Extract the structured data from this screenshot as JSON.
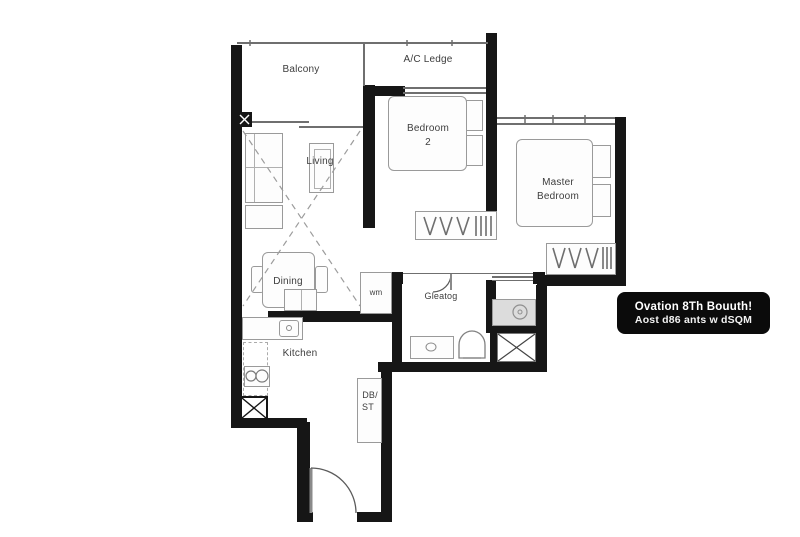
{
  "canvas": {
    "width": 800,
    "height": 537,
    "background": "#ffffff"
  },
  "colors": {
    "wall": "#161616",
    "thin_line": "#6f6f6f",
    "furniture_stroke": "#9a9a9a",
    "label_text": "#3d3d3d",
    "shower_fill": "#dcdcdc",
    "badge_background": "#0b0b0b",
    "badge_text": "#ffffff"
  },
  "rooms": {
    "balcony": "Balcony",
    "ac_ledge": "A/C Ledge",
    "living": "Living",
    "dining": "Dining",
    "kitchen": "Kitchen",
    "bedroom2_line1": "Bedroom",
    "bedroom2_line2": "2",
    "master_line1": "Master",
    "master_line2": "Bedroom",
    "bath": "Gleatog",
    "washer": "wm",
    "db_line1": "DB/",
    "db_line2": "ST"
  },
  "badge": {
    "line1": "Ovation 8Th Bouuth!",
    "line2": "Aost d86 ants w dSQM"
  }
}
